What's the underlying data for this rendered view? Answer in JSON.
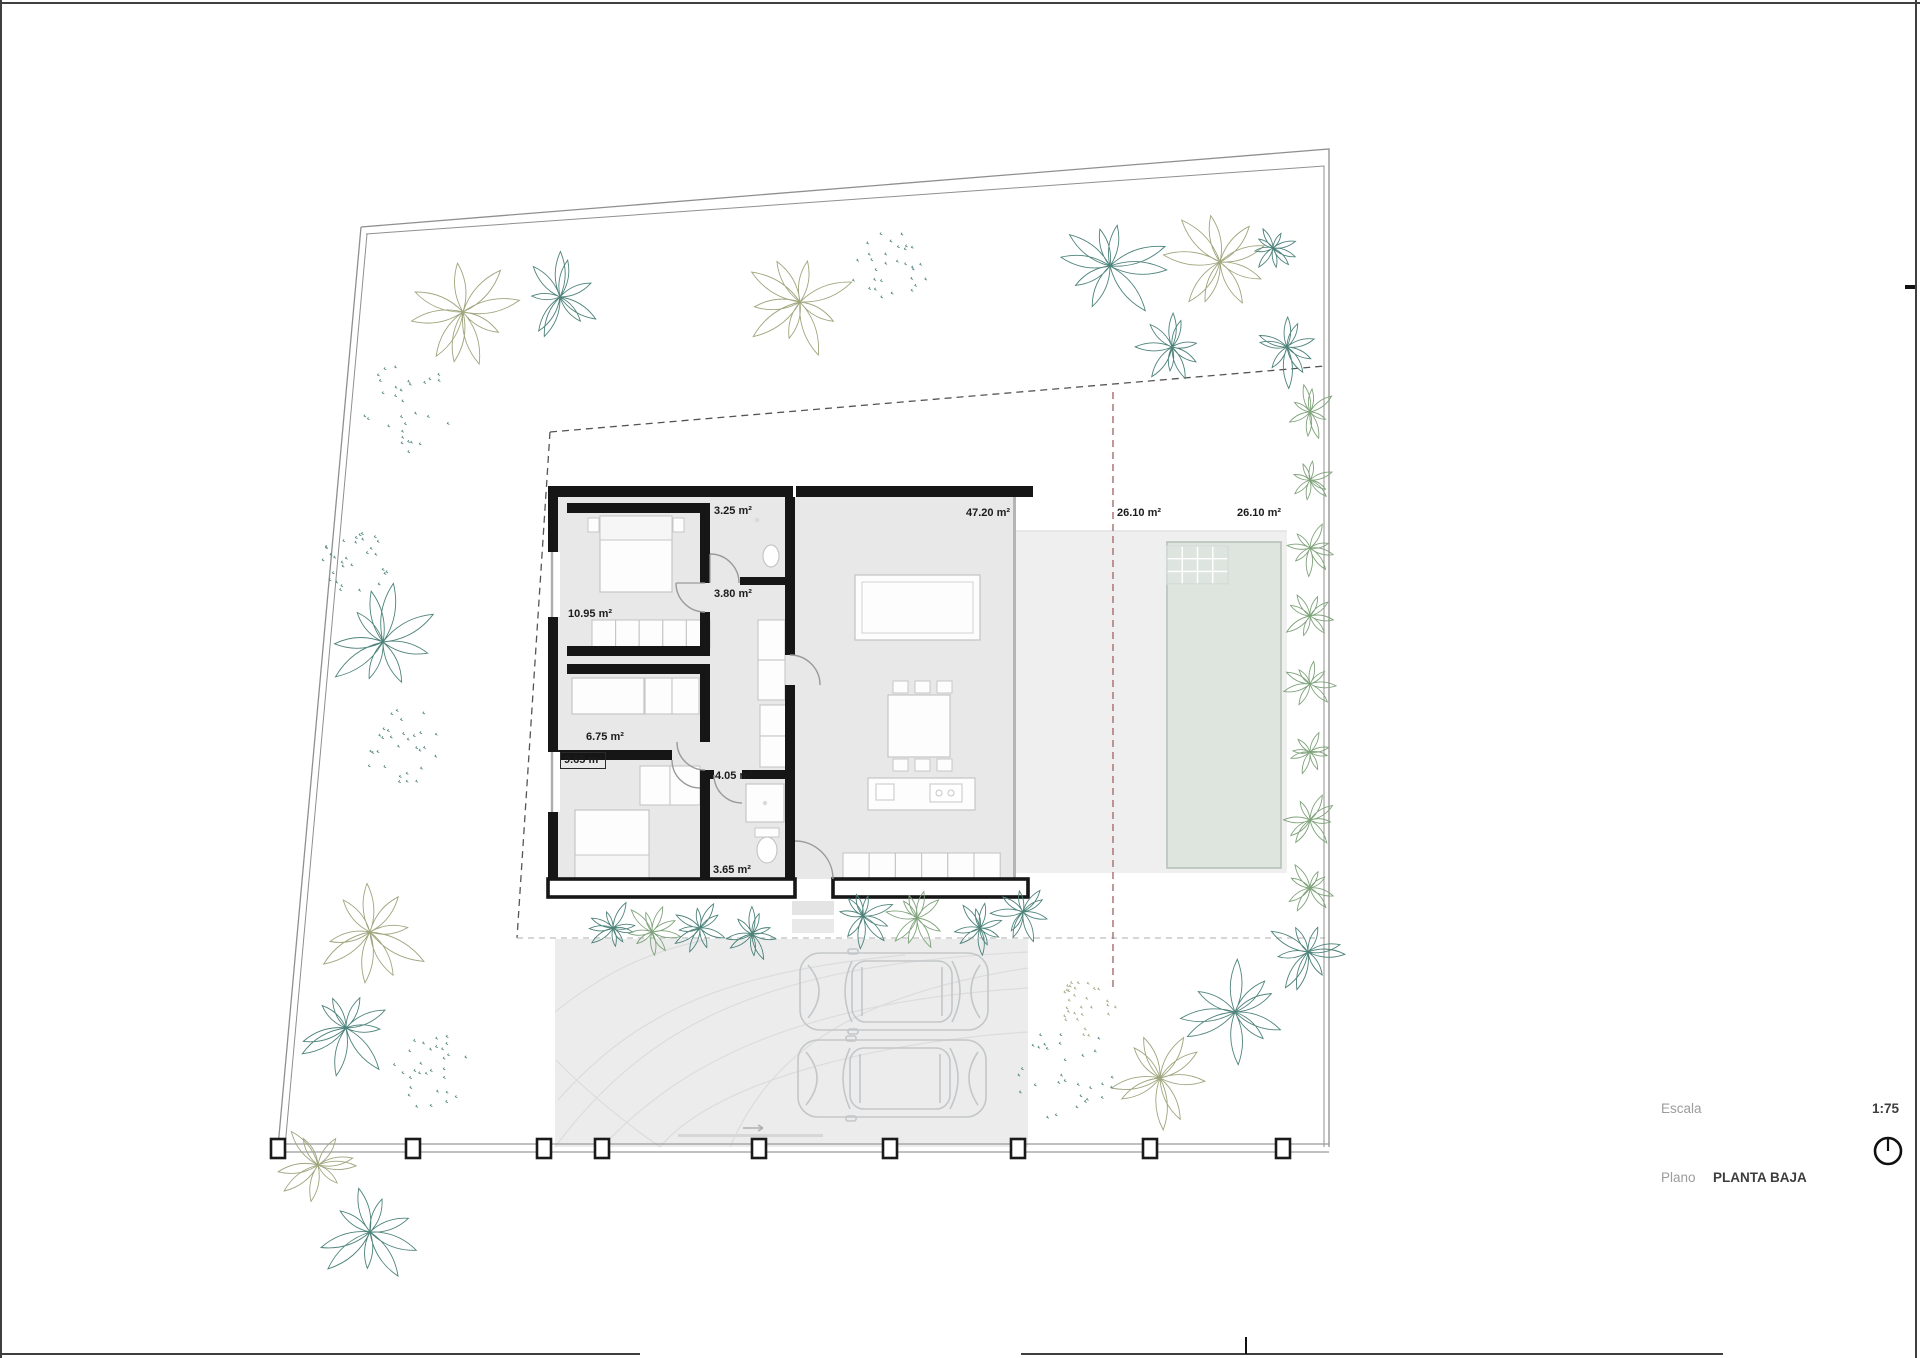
{
  "drawing": {
    "type": "architectural-floor-plan",
    "rooms": [
      {
        "label": "3.25 m²"
      },
      {
        "label": "47.20 m²"
      },
      {
        "label": "26.10 m²"
      },
      {
        "label": "26.10 m²"
      },
      {
        "label": "3.80 m²"
      },
      {
        "label": "10.95 m²"
      },
      {
        "label": "6.75 m²"
      },
      {
        "label": "9.65 m²"
      },
      {
        "label": "4.05 m²"
      },
      {
        "label": "3.65 m²"
      }
    ],
    "titleblock": {
      "escala_label": "Escala",
      "escala_value": "1:75",
      "plano_label": "Plano",
      "plano_value": "PLANTA BAJA"
    },
    "icons": {
      "north_icon": "circle-with-needle"
    },
    "colors": {
      "wall": "#161616",
      "floor": "#e8e8e8",
      "terrace": "#efefef",
      "driveway": "#ececec",
      "pool_fill": "#dee5df",
      "pool_border": "#b7c2b8",
      "boundary": "#8f8f8d",
      "setback_dash": "#555555",
      "alignment_dash_red": "#a06060",
      "tree_teal": "#4e837b",
      "tree_olive": "#9fa57d",
      "tree_green": "#7fa37b",
      "car_outline": "#c3c7c9",
      "label_text": "#1c1c1c",
      "titleblock_muted": "#9c9c9c"
    }
  }
}
